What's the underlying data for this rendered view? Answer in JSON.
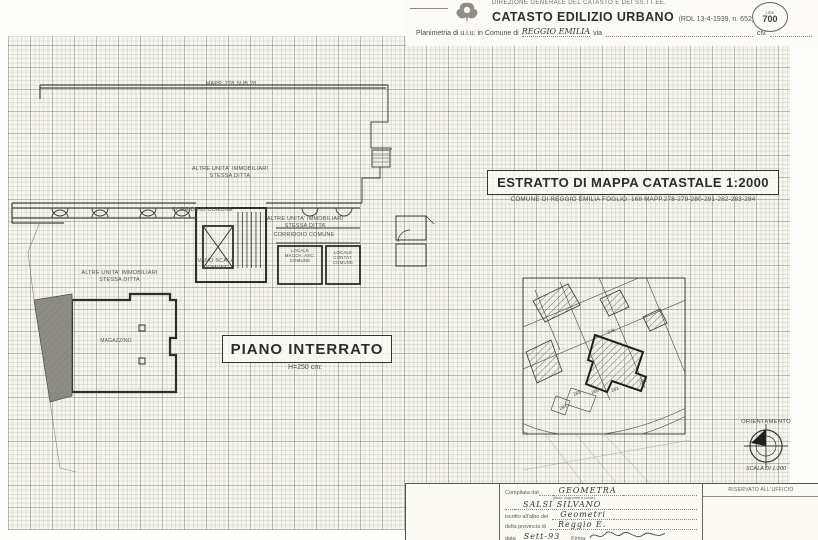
{
  "header": {
    "dept_line": "DIREZIONE GENERALE DEL CATASTO E DEI SS.TT.EE.",
    "title": "CATASTO EDILIZIO URBANO",
    "title_ref": "(RDL 13-4-1939, n. 652)",
    "stamp_lire": "LIRE",
    "stamp_value": "700",
    "planimetria_label": "Planimetria di u.i.u. in Comune di",
    "comune_value": "REGGIO EMILIA",
    "via_label": "via",
    "civ_label": "civ."
  },
  "plan": {
    "map_ref": "MAPP. 278 SUB.28",
    "labels": {
      "altre_unita_top": [
        "ALTRE UNITA' IMMOBILIARI",
        "STESSA DITTA"
      ],
      "corridoio_left": "CORRIDOIO COMUNE",
      "altre_unita_right": [
        "ALTRE UNITA' IMMOBILIARI",
        "STESSA DITTA"
      ],
      "corridoio_right": "CORRIDOIO COMUNE",
      "vano_scala": [
        "VANO SCALA",
        "COMUNE"
      ],
      "locale_macch": [
        "LOCALE",
        "MACCH. ASC.",
        "COMUNE"
      ],
      "locale_contat": [
        "LOCALE",
        "CONTAT.",
        "COMUNE"
      ],
      "altre_unita_bottom": [
        "ALTRE UNITA' IMMOBILIARI",
        "STESSA DITTA"
      ],
      "magazzino": "MAGAZZINO"
    },
    "title": "PIANO INTERRATO",
    "height_note": "H=250 cm:"
  },
  "map_extract": {
    "title": "ESTRATTO DI MAPPA CATASTALE 1:2000",
    "subtitle": "COMUNE DI REGGIO EMILIA FOGLIO: 168 MAPP.278-279-280-281-282-283-284",
    "parcel_numbers": [
      "278",
      "280",
      "281",
      "282",
      "283",
      "284"
    ]
  },
  "orientation": {
    "label": "ORIENTAMENTO",
    "scale": "SCALA DI 1:200"
  },
  "form": {
    "compilata_label": "Compilata dal",
    "compilata_value": "GEOMETRA",
    "name_hint": "(titolo, cognome e nome)",
    "name_value": "SALSI SILVANO",
    "albo_label": "iscritto all'albo dei",
    "albo_value": "Geometri",
    "provincia_label": "della provincia di",
    "provincia_value": "Reggio E.",
    "data_label": "data",
    "data_value": "Sett-93",
    "firma_label": "Firma",
    "ufficio_label": "RISERVATO ALL'UFFICIO"
  }
}
